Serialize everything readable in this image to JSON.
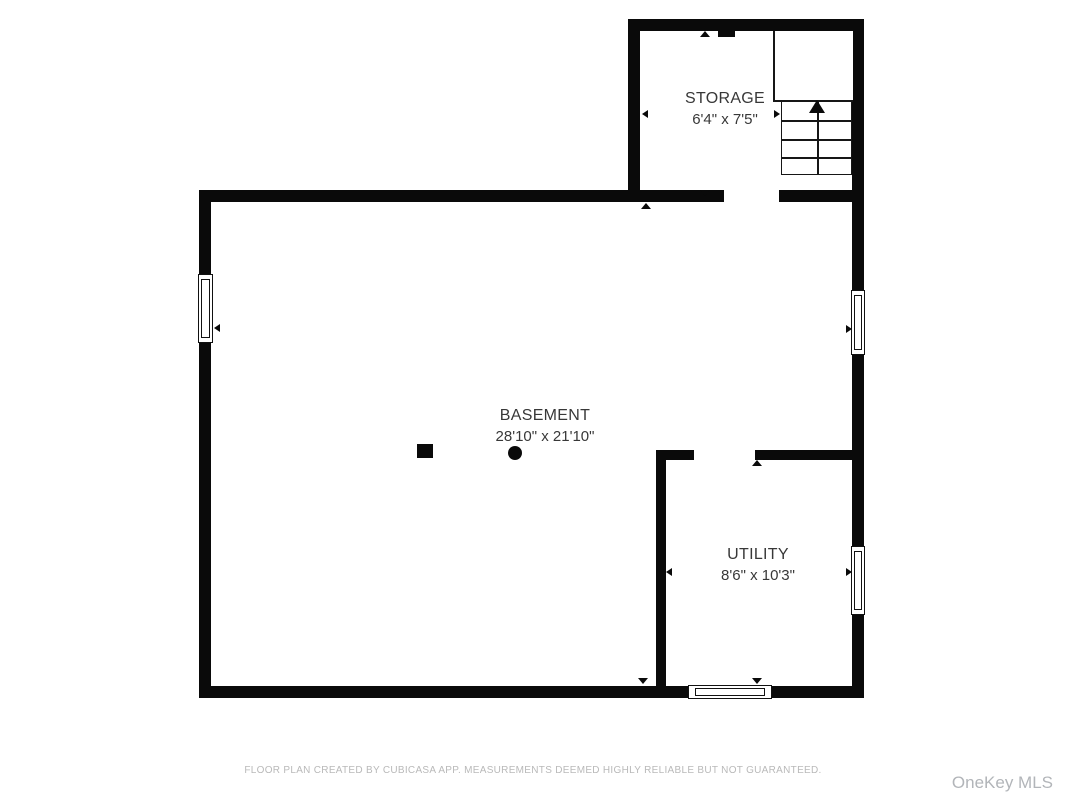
{
  "colors": {
    "background": "#ffffff",
    "wall": "#0a0a0a",
    "label-text": "#383838",
    "footer-text": "#b9b9b9",
    "watermark-text": "#b2b5b9"
  },
  "floorplan": {
    "rooms": [
      {
        "name": "STORAGE",
        "dims": "6'4\" x 7'5\""
      },
      {
        "name": "BASEMENT",
        "dims": "28'10\" x 21'10\""
      },
      {
        "name": "UTILITY",
        "dims": "8'6\" x 10'3\""
      }
    ]
  },
  "footer": {
    "disclaimer": "FLOOR PLAN CREATED BY CUBICASA APP. MEASUREMENTS DEEMED HIGHLY RELIABLE BUT NOT GUARANTEED."
  },
  "watermark": "OneKey MLS"
}
